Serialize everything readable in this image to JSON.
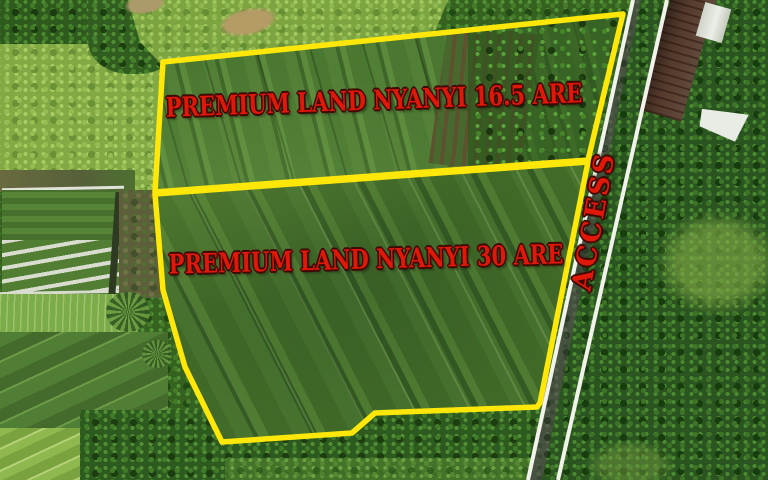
{
  "plots": [
    {
      "label": "PREMIUM LAND NYANYI 16.5 ARE"
    },
    {
      "label": "PREMIUM LAND NYANYI 30 ARE"
    }
  ],
  "road": {
    "label": "ACCESS"
  },
  "colors": {
    "boundary_yellow": "#ffe70a",
    "label_red": "#e0180a",
    "label_outline": "#3f0a04",
    "road_line_white": "#f1f3ea"
  }
}
